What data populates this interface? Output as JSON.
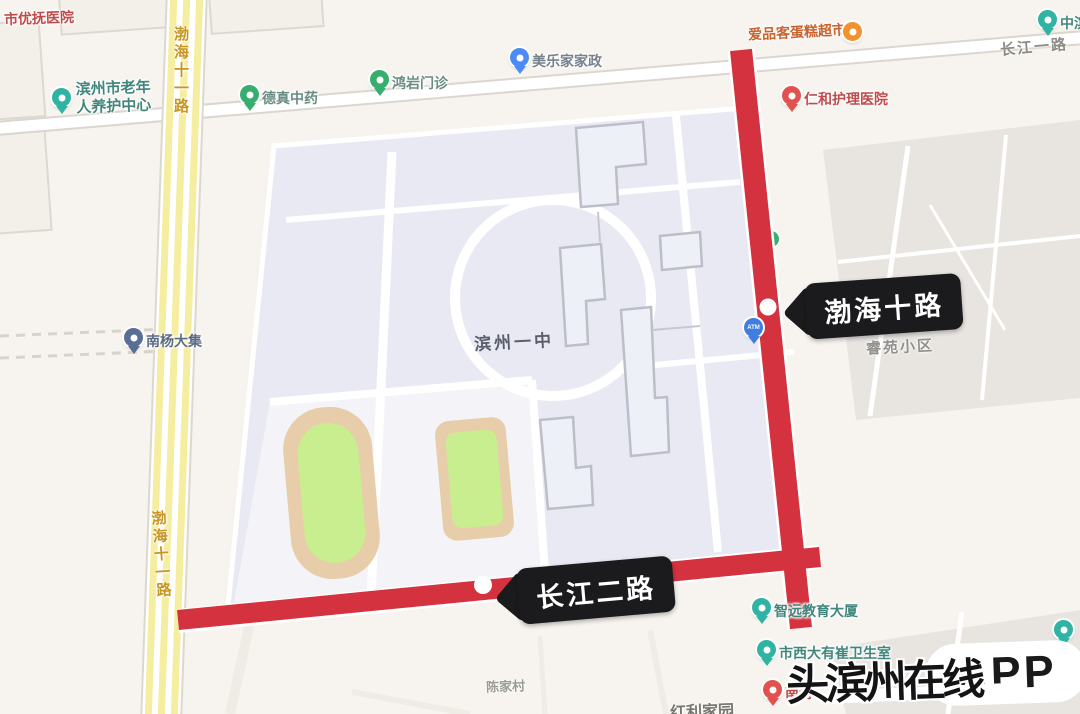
{
  "colors": {
    "map_background": "#f7f4ef",
    "highlight_road_red": "#d5323f",
    "callout_background": "#1b1b1d",
    "campus_fill": "#e9e9f3",
    "sports_field_green": "#c9ee8f",
    "running_track_tan": "#e7cda9",
    "yellow_road_stripe": "#f5eda0",
    "pin_teal": "#2fb3a3",
    "pin_green": "#35ae6e",
    "pin_blue": "#4c8bf5",
    "pin_red": "#e0514f",
    "pin_orange": "#f0932f"
  },
  "labels": {
    "school": "滨州一中",
    "bohai11_top": "渤海十一路",
    "bohai11_bottom": "渤海十一路",
    "changjiang1": "长江一路",
    "ruiyuan": "睿苑小区",
    "chenjiacun": "陈家村",
    "hongli": "红利家园"
  },
  "callouts": {
    "bohai": {
      "label": "渤海十路"
    },
    "changjiang": {
      "label": "长江二路"
    }
  },
  "watermark": {
    "text": "头滨州在线",
    "app": "APP"
  },
  "pois": [
    {
      "label": "市优抚医院"
    },
    {
      "line1": "滨州市老年",
      "line2": "人养护中心"
    },
    {
      "label": "德真中药"
    },
    {
      "label": "鸿岩门诊"
    },
    {
      "label": "美乐家家政"
    },
    {
      "label": "爱品客蛋糕超市"
    },
    {
      "label": "中滨"
    },
    {
      "label": "仁和护理医院"
    },
    {
      "label": "南杨大集"
    },
    {
      "label": "ATM"
    },
    {
      "label": "智远教育大厦"
    },
    {
      "label": "市西大有崔卫生室"
    },
    {
      "label": "南海"
    }
  ]
}
